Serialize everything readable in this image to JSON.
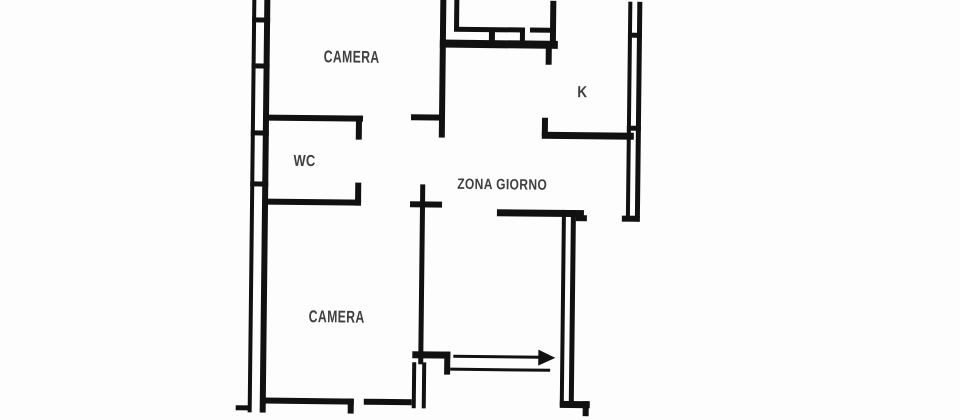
{
  "plan": {
    "title": "apartment-floor-plan",
    "rooms": [
      {
        "label": "CAMERA"
      },
      {
        "label": "WC"
      },
      {
        "label": "ZONA GIORNO"
      },
      {
        "label": "K"
      },
      {
        "label": "CAMERA"
      }
    ],
    "icons": {
      "entrance_arrow": "right-arrow"
    },
    "colors": {
      "wall": "#111111",
      "text": "#3f3f3f",
      "background": "#fdfdfd"
    }
  }
}
